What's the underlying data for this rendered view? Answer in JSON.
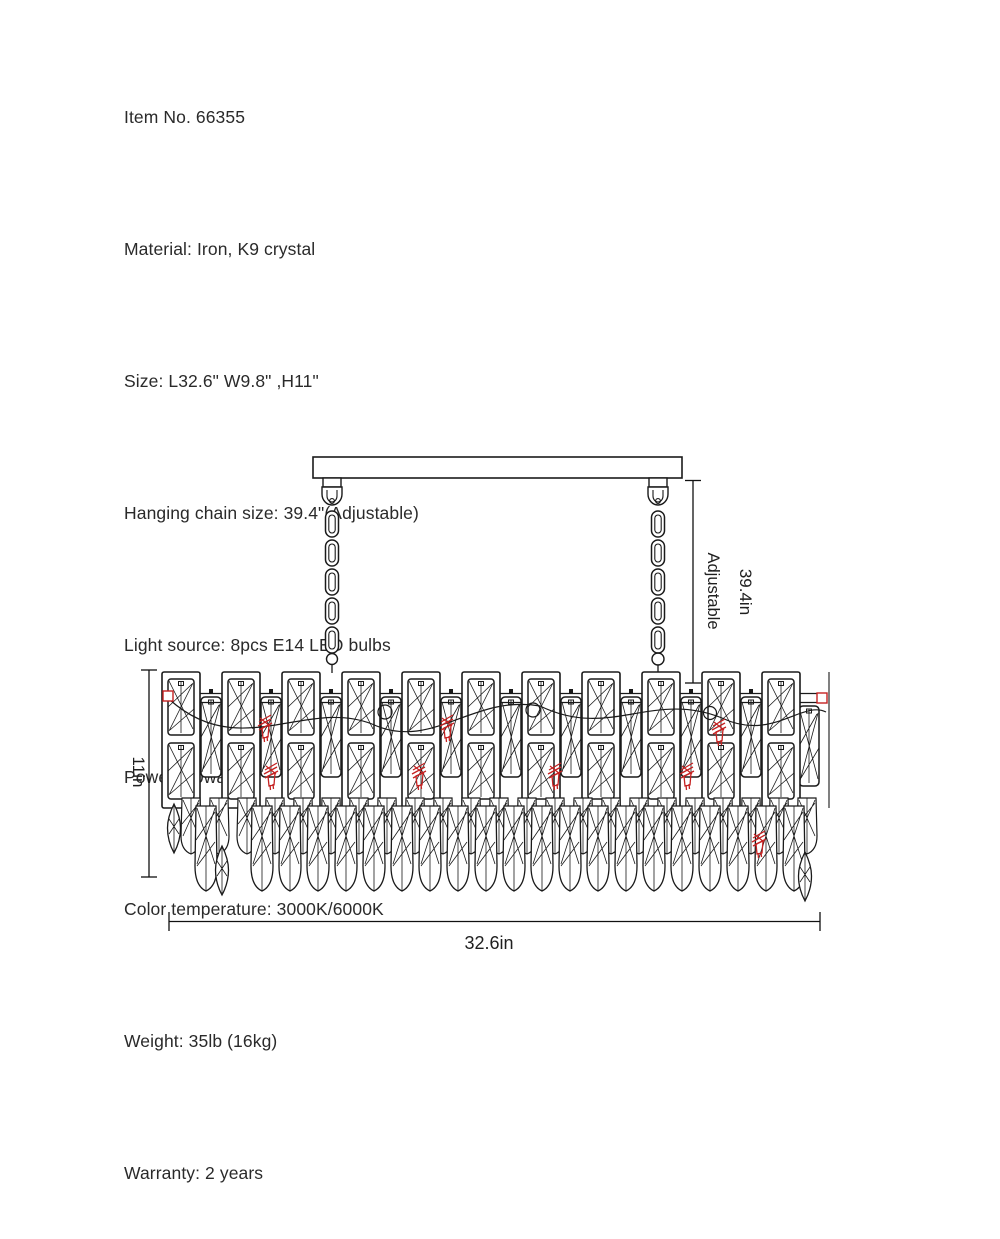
{
  "specs": {
    "lines": [
      "Item No. 66355",
      "Material: Iron, K9 crystal",
      "Size: L32.6\" W9.8\" ,H11\"",
      "Hanging chain size: 39.4\"(Adjustable)",
      "Light source: 8pcs E14 LED bulbs",
      "Power: 40watts",
      "Color temperature: 3000K/6000K",
      "Weight: 35lb (16kg)",
      "Warranty: 2 years"
    ]
  },
  "diagram": {
    "labels": {
      "chain_length": "39.4in",
      "chain_note": "Adjustable",
      "fixture_height": "11in",
      "fixture_length": "32.6in"
    },
    "colors": {
      "line": "#1a1a1a",
      "accent_red": "#c52222"
    }
  }
}
